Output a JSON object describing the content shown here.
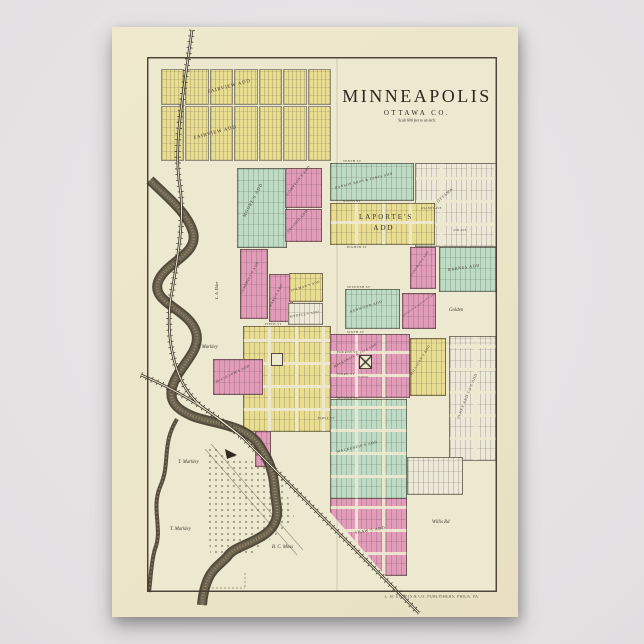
{
  "poster": {
    "title": "MINNEAPOLIS",
    "county": "OTTAWA CO.",
    "scale_note": "Scale 600 feet to an inch.",
    "publisher": "L. H. EVERTS & CO. PUBLISHERS, PHILA. PA."
  },
  "additions": {
    "fairview_n": "FAIRVIEW ADD",
    "fairview_s": "FAIRVIEW ADD",
    "moores": "MOORE'S ADD",
    "comptons": "COMPTON'S ADD",
    "second": "SECOND ADD",
    "hanson": "HANSON BROS & JONES ADD",
    "ottawa": "ADD OF OTTAWA",
    "laportes": "LAPORTE'S ADD",
    "stinemans": "STINEMAN'S ADD",
    "barnes": "BARNES ADD",
    "kenwood": "KENWOOD ADD",
    "houston": "HOUSTON & JOHNSON'S ADD",
    "campbells": "CAMPBELL'S ADD",
    "wards": "WARD'S ADD",
    "colmans": "COLMAN'S ADD",
    "myrtles": "MYRTLE'S ADD",
    "mccolloms": "McCOLLOM'S ADD",
    "mackenzie_co": "MACKENZIE & CO'S ADD",
    "milligans": "MILLIGAN'S ADD",
    "olney": "OLNEY AND CO'S ADD",
    "mackenzies": "MACKENZIE'S ADD",
    "shaws": "SHAW'S ADD"
  },
  "streets": [
    "TENTH ST",
    "NINTH ST",
    "EIGHTH ST",
    "SEVENTH ST",
    "SIXTH ST",
    "FIFTH ST",
    "FOURTH ST",
    "THIRD ST",
    "SECOND ST",
    "FIRST ST"
  ],
  "avenues": [
    "WALNUT AVE",
    "ASH AVE"
  ],
  "landowners": {
    "markley_1": "T. Markley",
    "markley_2": "T. Markley",
    "markley_3": "T. Markley",
    "moss": "B. C. Moss",
    "golden": "Golden",
    "elder": "L. A. Elder"
  },
  "roads": {
    "willis": "Willis Rd"
  },
  "landmarks": {
    "school": "SCHOOL"
  },
  "colors": {
    "background": "#e2e0e1",
    "paper": "#ece5c9",
    "map_ground": "#ede8d0",
    "block_yellow": "#e9dd92",
    "block_pink": "#e29cba",
    "block_green": "#bedcc5",
    "block_white": "#ede9d8",
    "ink": "#413a2e",
    "river": "#57503f"
  }
}
